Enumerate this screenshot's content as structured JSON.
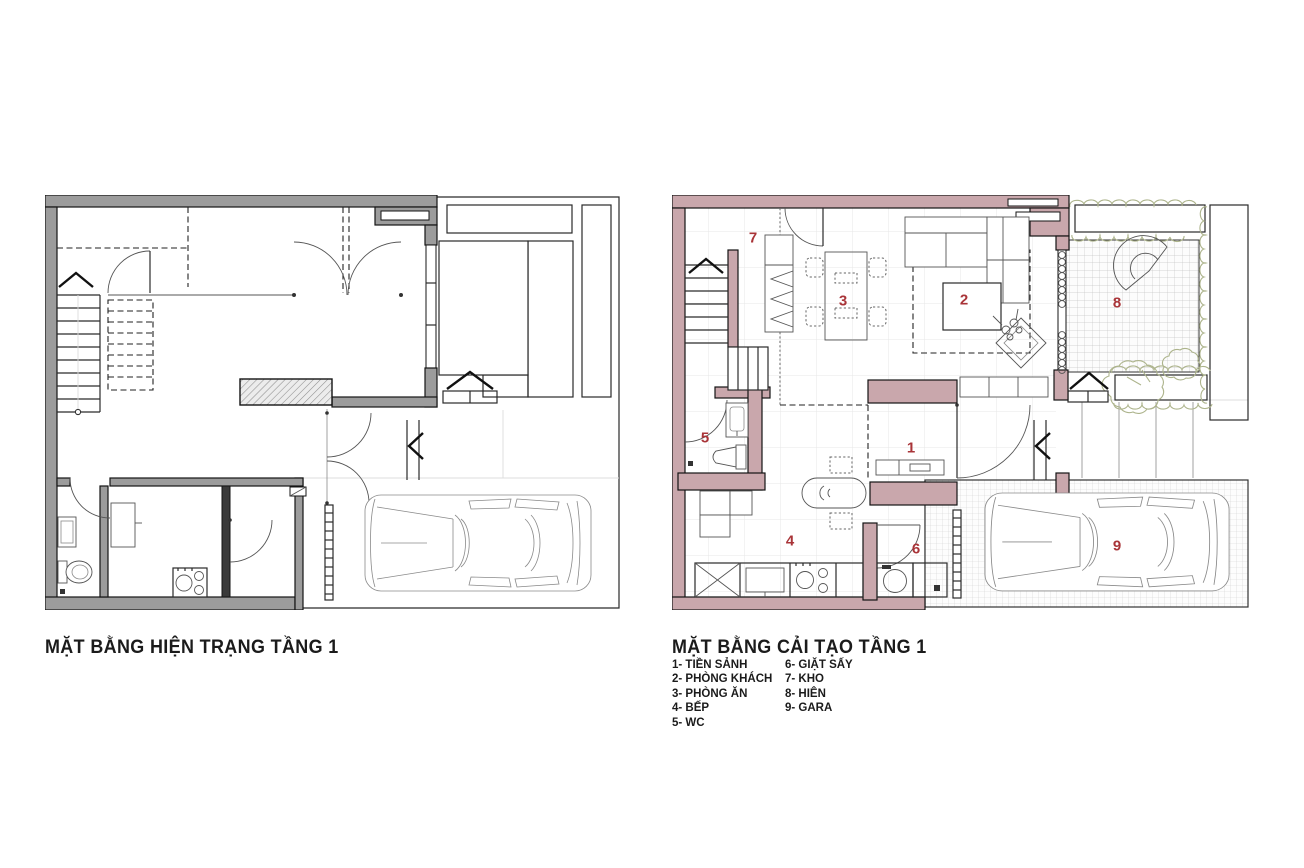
{
  "plans": {
    "existing": {
      "title": "MẶT BẰNG HIỆN TRẠNG TẦNG 1"
    },
    "renovated": {
      "title": "MẶT BẰNG CẢI TẠO TẦNG 1",
      "rooms": [
        {
          "number": "1",
          "name": "TIỀN SẢNH"
        },
        {
          "number": "2",
          "name": "PHÒNG KHÁCH"
        },
        {
          "number": "3",
          "name": "PHÒNG ĂN"
        },
        {
          "number": "4",
          "name": "BẾP"
        },
        {
          "number": "5",
          "name": "WC"
        },
        {
          "number": "6",
          "name": "GIẶT SẤY"
        },
        {
          "number": "7",
          "name": "KHO"
        },
        {
          "number": "8",
          "name": "HIÊN"
        },
        {
          "number": "9",
          "name": "GARA"
        }
      ]
    }
  },
  "legend": {
    "col1": [
      "1- TIỀN SẢNH",
      "2- PHÒNG KHÁCH",
      "3- PHÒNG ĂN",
      "4- BẾP",
      "5- WC"
    ],
    "col2": [
      "6- GIẶT SẤY",
      "7- KHO",
      "8- HIÊN",
      "9- GARA"
    ]
  },
  "colors": {
    "wall_existing": "#9c9c9c",
    "wall_renovated": "#c9a7ac",
    "room_number": "#a93438",
    "planting_green": "#8fbe8b"
  }
}
